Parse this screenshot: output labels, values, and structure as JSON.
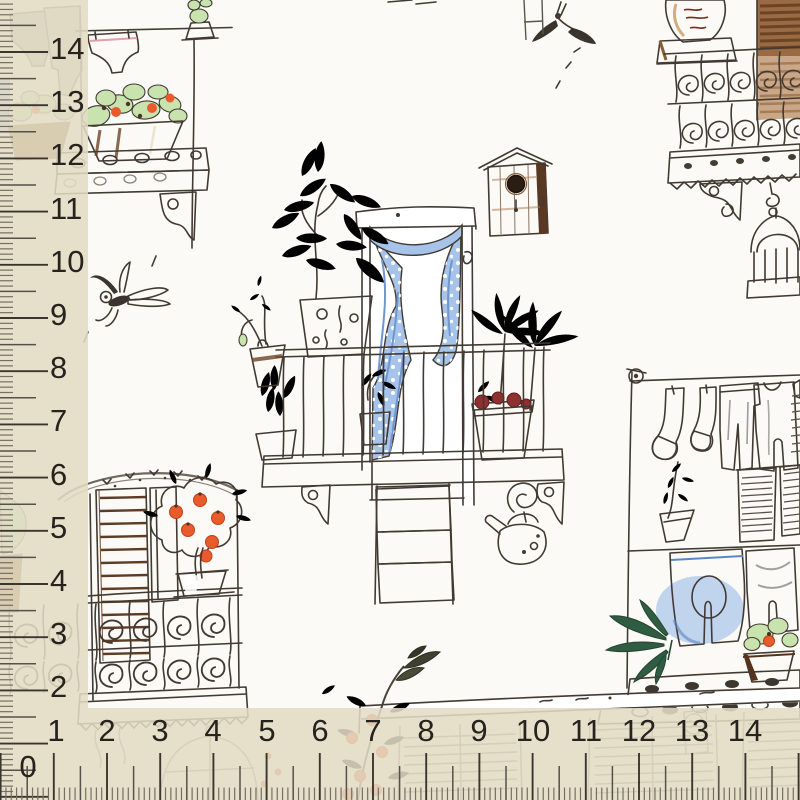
{
  "scene": {
    "kind": "fabric swatch photographed with measuring rulers",
    "pattern_name": "Italian balconies with plants, laundry, flag and birdhouses"
  },
  "rulers": {
    "band_color": "#e2dbc4",
    "text_color": "#26231f",
    "tick_color": "#3a352e",
    "left": {
      "labels": [
        "14",
        "13",
        "12",
        "11",
        "10",
        "9",
        "8",
        "7",
        "6",
        "5",
        "4",
        "3",
        "2"
      ]
    },
    "bottom": {
      "labels": [
        "2",
        "3",
        "4",
        "5",
        "6",
        "7",
        "8",
        "9",
        "10",
        "11",
        "12",
        "13",
        "14"
      ]
    },
    "corner": {
      "zero": "0",
      "one": "1"
    }
  },
  "fabric": {
    "base_color": "#fcfaf6",
    "ink_color": "#423a32",
    "motifs": [
      "balcony",
      "wrought-iron-railing",
      "italian-flag",
      "birdhouse",
      "birdcage",
      "watering-can",
      "clothesline",
      "orange-tree",
      "cactus-pots",
      "dragonfly-sketch",
      "fly-sketch",
      "pink-laundry",
      "blue-curtains"
    ],
    "colors": {
      "fabric_base": "#fcfaf6",
      "ink": "#423a32",
      "ruler_text": "#26231f",
      "flag_green": "#10b576",
      "flag_red": "#f2415e",
      "curtain_blue": "#a6c3e9",
      "curtain_blue_deep": "#6f97cf",
      "clothes_blue": "#7aa6e4",
      "laundry_pink": "#f6c6c9",
      "leaf_green": "#c8e3ae",
      "leaf_dark": "#2f5c42",
      "fruit_orange": "#e95a2c",
      "pot_brown": "#96622f",
      "pot_brown_dark": "#6e4423",
      "pot_red": "#d84444",
      "shutter_brown": "#a06c46",
      "shutter_slat": "#5d3b24",
      "cloth_gray": "#c9c9c7",
      "ledge_gray": "#dcdcd9"
    }
  }
}
